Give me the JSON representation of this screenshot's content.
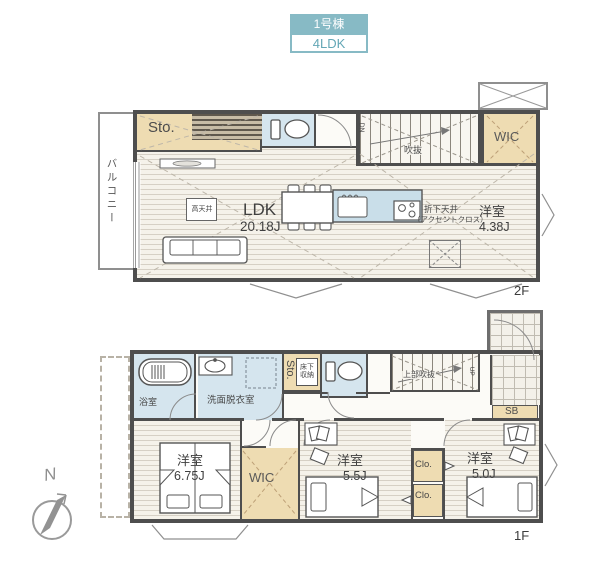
{
  "header": {
    "building_no": "1号棟",
    "layout_type": "4LDK"
  },
  "floor2": {
    "floor_label": "2F",
    "balcony_label": "バルコニー",
    "storage_label": "Sto.",
    "void_label": "吹抜",
    "down_label": "DN",
    "wic_label": "WIC",
    "ldk": {
      "name": "LDK",
      "size": "20.18J"
    },
    "high_ceiling_label": "高天井",
    "dropped_ceiling_line1": "折下天井",
    "dropped_ceiling_line2": "（アクセントクロス）",
    "bedroom": {
      "name": "洋室",
      "size": "4.38J"
    }
  },
  "floor1": {
    "floor_label": "1F",
    "bathroom_label": "浴室",
    "washroom_label": "洗面脱衣室",
    "storage_label": "Sto.",
    "underfloor_storage_label": "床下収納",
    "upper_void_label": "上部吹抜",
    "up_label": "UP",
    "shoe_box_label": "SB",
    "wic_label": "WIC",
    "closet1_label": "Clo.",
    "closet2_label": "Clo.",
    "bedroom1": {
      "name": "洋室",
      "size": "6.75J"
    },
    "bedroom2": {
      "name": "洋室",
      "size": "5.5J"
    },
    "bedroom3": {
      "name": "洋室",
      "size": "5.0J"
    }
  },
  "compass": {
    "north_label": "N"
  },
  "colors": {
    "accent_teal": "#87bac5",
    "room_blue": "#d5e5ee",
    "room_beige": "#eedcb2",
    "wall": "#4e4e4e"
  }
}
